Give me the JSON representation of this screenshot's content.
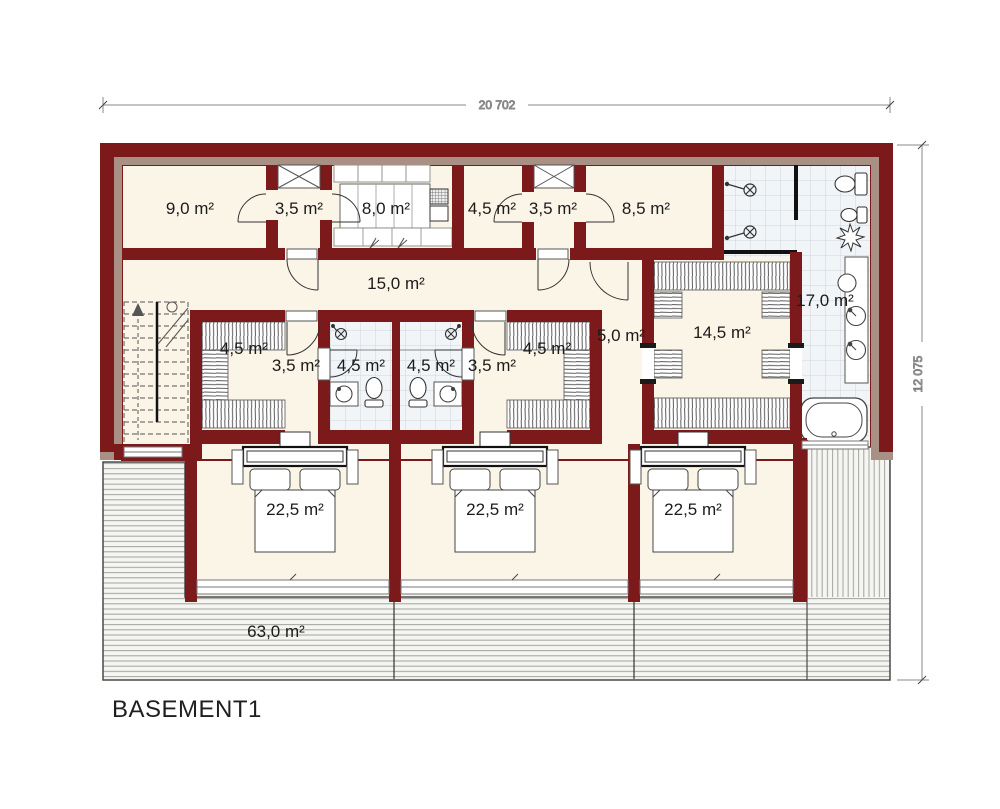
{
  "title": "BASEMENT1",
  "dimensions": {
    "width": "20 702",
    "height": "12 075"
  },
  "areas": {
    "storage": "9,0 m²",
    "shaft_a": "3,5 m²",
    "laundry": "8,0 m²",
    "utility": "4,5 m²",
    "shaft_b": "3,5 m²",
    "storage2": "8,5 m²",
    "corridor": "15,0 m²",
    "bathroom_main": "17,0 m²",
    "closet_left": "4,5 m²",
    "hall_left": "3,5 m²",
    "bath_left": "4,5 m²",
    "bath_right": "4,5 m²",
    "hall_right": "3,5 m²",
    "closet_right": "4,5 m²",
    "hall_center": "5,0 m²",
    "closet_master": "14,5 m²",
    "bedroom_1": "22,5 m²",
    "bedroom_2": "22,5 m²",
    "bedroom_3": "22,5 m²",
    "terrace": "63,0 m²"
  },
  "colors": {
    "wall": "#7c191b",
    "insulation": "#a89084",
    "floor": "#fbf5e8",
    "tile": "#f1f5f8",
    "deck": "#f5f5f2"
  }
}
